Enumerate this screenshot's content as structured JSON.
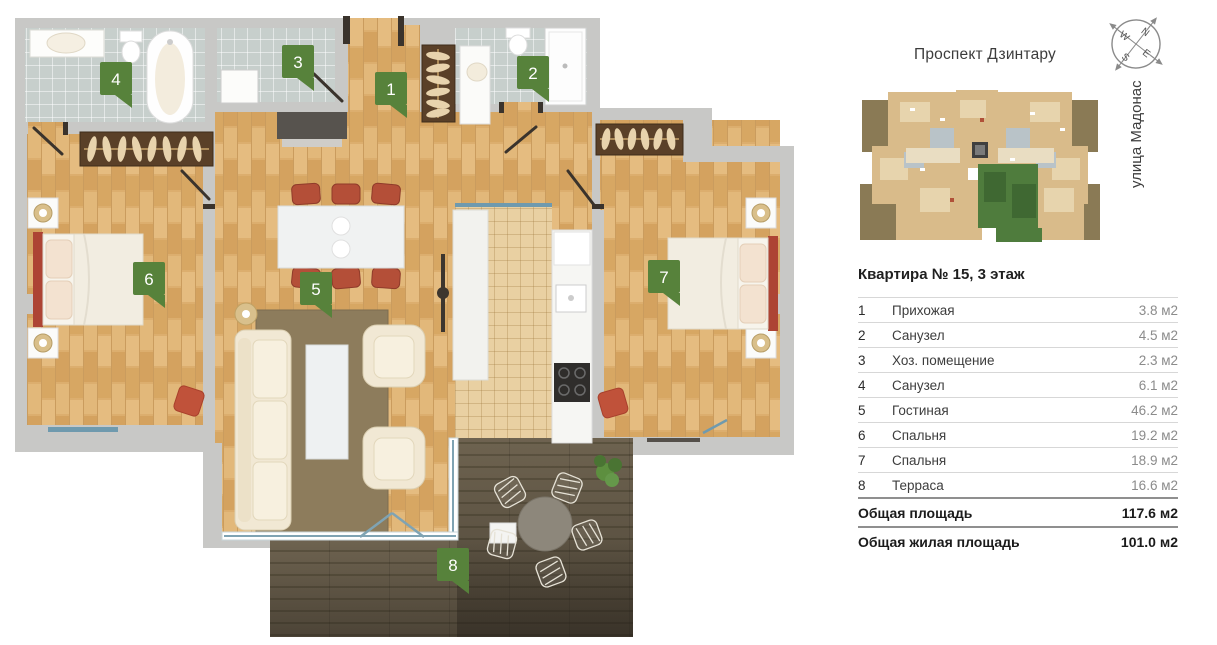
{
  "site": {
    "street_top": "Проспект Дзинтару",
    "street_right": "улица Мадонас"
  },
  "compass": {
    "n": "N",
    "e": "E",
    "s": "S",
    "w": "W"
  },
  "apartment": {
    "title": "Квартира № 15, 3 этаж",
    "rooms": [
      {
        "num": "1",
        "name": "Прихожая",
        "area": "3.8 м2"
      },
      {
        "num": "2",
        "name": "Санузел",
        "area": "4.5 м2"
      },
      {
        "num": "3",
        "name": "Хоз. помещение",
        "area": "2.3 м2"
      },
      {
        "num": "4",
        "name": "Санузел",
        "area": "6.1 м2"
      },
      {
        "num": "5",
        "name": "Гостиная",
        "area": "46.2 м2"
      },
      {
        "num": "6",
        "name": "Спальня",
        "area": "19.2 м2"
      },
      {
        "num": "7",
        "name": "Спальня",
        "area": "18.9 м2"
      },
      {
        "num": "8",
        "name": "Терраса",
        "area": "16.6 м2"
      }
    ],
    "totals": [
      {
        "label": "Общая площадь",
        "value": "117.6 м2"
      },
      {
        "label": "Общая жилая площадь",
        "value": "101.0 м2"
      }
    ]
  },
  "colors": {
    "badge_green": "#57823b",
    "selected_unit_green": "#4f7c3d",
    "wood_floor": "#dcae6e",
    "bath_tile": "#c7cfcc",
    "kitchen_tile": "#e9d0a2",
    "terrace_deck": "#6e6350",
    "wall_gray": "#c8c8c6",
    "furniture_red": "#c0523a",
    "window_teal": "#6f9aae"
  }
}
